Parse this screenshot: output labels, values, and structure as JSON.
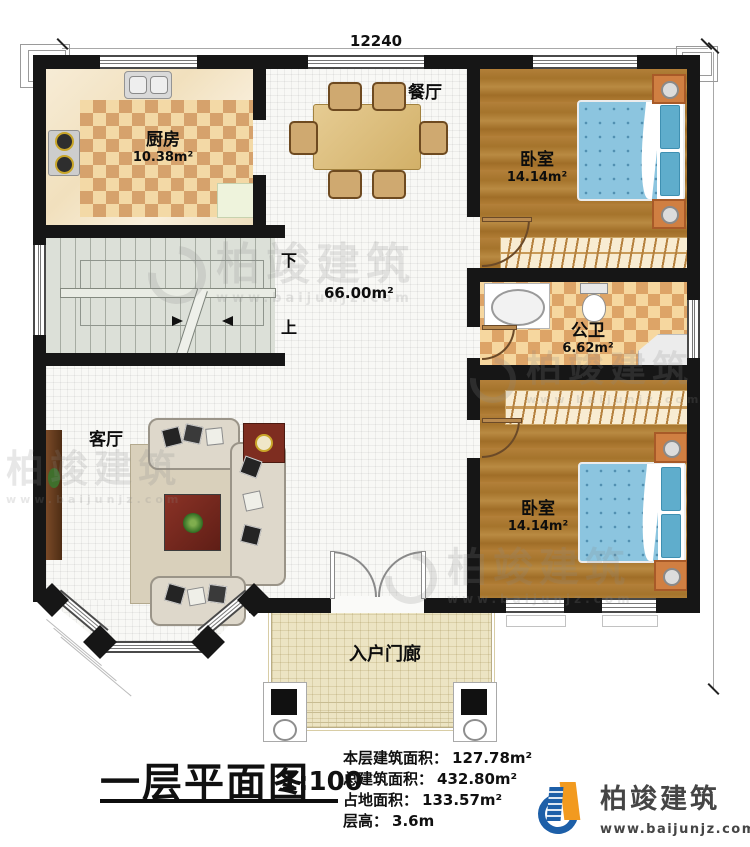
{
  "dimensions": {
    "top": "12240",
    "right": "11720"
  },
  "rooms": {
    "kitchen": {
      "name": "厨房",
      "area": "10.38m²"
    },
    "dining": {
      "name": "餐厅"
    },
    "bedroom_top": {
      "name": "卧室",
      "area": "14.14m²"
    },
    "bathroom": {
      "name": "公卫",
      "area": "6.62m²"
    },
    "bedroom_bottom": {
      "name": "卧室",
      "area": "14.14m²"
    },
    "living": {
      "name": "客厅"
    },
    "porch": {
      "name": "入户门廊"
    },
    "stairs": {
      "down": "下",
      "up": "上",
      "area": "66.00m²"
    }
  },
  "title_block": {
    "title": "一层平面图",
    "scale": "1:100",
    "stats": [
      {
        "label": "本层建筑面积：",
        "value": "127.78m²"
      },
      {
        "label": "总建筑面积：",
        "value": "432.80m²"
      },
      {
        "label": "占地面积：",
        "value": "133.57m²"
      },
      {
        "label": "层高：",
        "value": "3.6m"
      }
    ]
  },
  "branding": {
    "company": "柏竣建筑",
    "website": "www.baijunjz.com"
  },
  "watermark": {
    "text": "柏竣建筑",
    "subtext": "www.baijunjz.com"
  },
  "colors": {
    "wall": "#161616",
    "wood": "#ab7a30",
    "bed": "#8cc5df",
    "accent_blue": "#1d5fa8",
    "accent_orange": "#f29a1f"
  }
}
